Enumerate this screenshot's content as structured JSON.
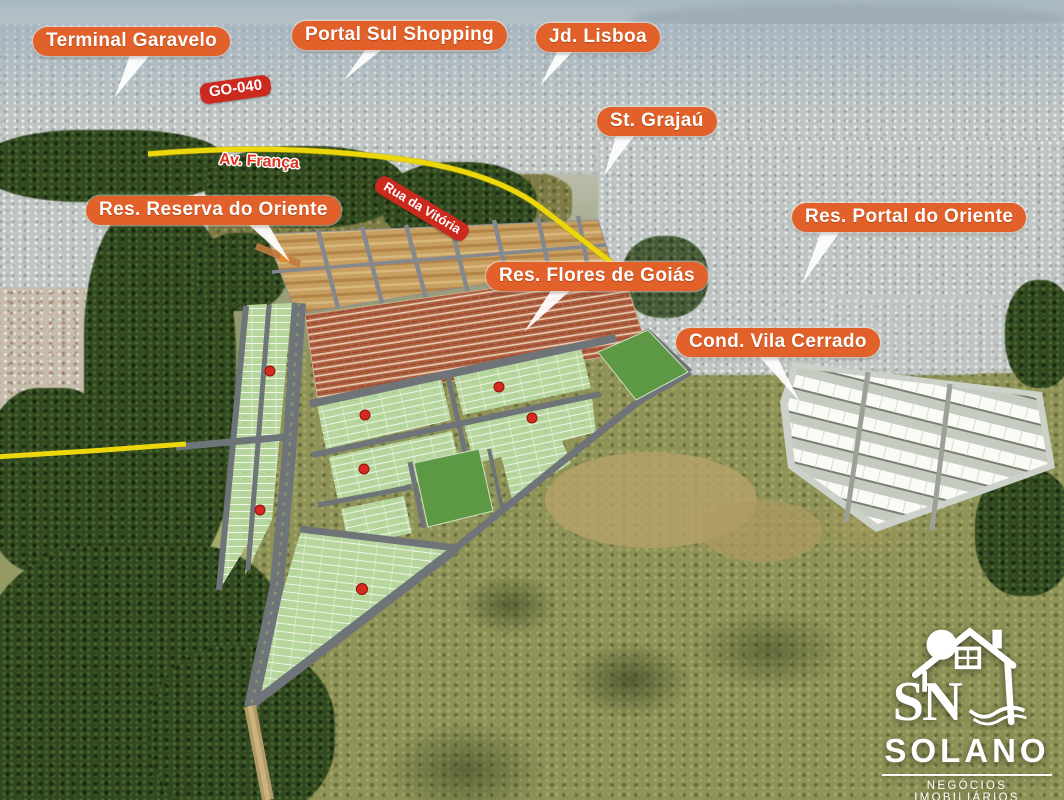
{
  "labels": {
    "terminal_garavelo": "Terminal Garavelo",
    "portal_sul_shopping": "Portal Sul Shopping",
    "jd_lisboa": "Jd. Lisboa",
    "st_grajau": "St. Grajaú",
    "res_reserva_do_oriente": "Res. Reserva do Oriente",
    "res_flores_de_goias": "Res. Flores de Goiás",
    "res_portal_do_oriente": "Res. Portal do Oriente",
    "cond_vila_cerrado": "Cond. Vila Cerrado"
  },
  "roads": {
    "go_040": "GO-040",
    "av_franca": "Av. França",
    "rua_da_vitoria": "Rua da Vitória"
  },
  "logo": {
    "initials": "SN",
    "name": "SOLANO",
    "tagline": "NEGÓCIOS IMOBILIÁRIOS"
  },
  "colors": {
    "label_orange": "#E2612A",
    "label_red": "#CC2A1E",
    "road_yellow": "#ECD70A",
    "plan_lot_green": "#B6D69E",
    "plan_reserved_green": "#5D9845",
    "plan_road_gray": "#6F7478",
    "marker_red": "#D42A20"
  }
}
